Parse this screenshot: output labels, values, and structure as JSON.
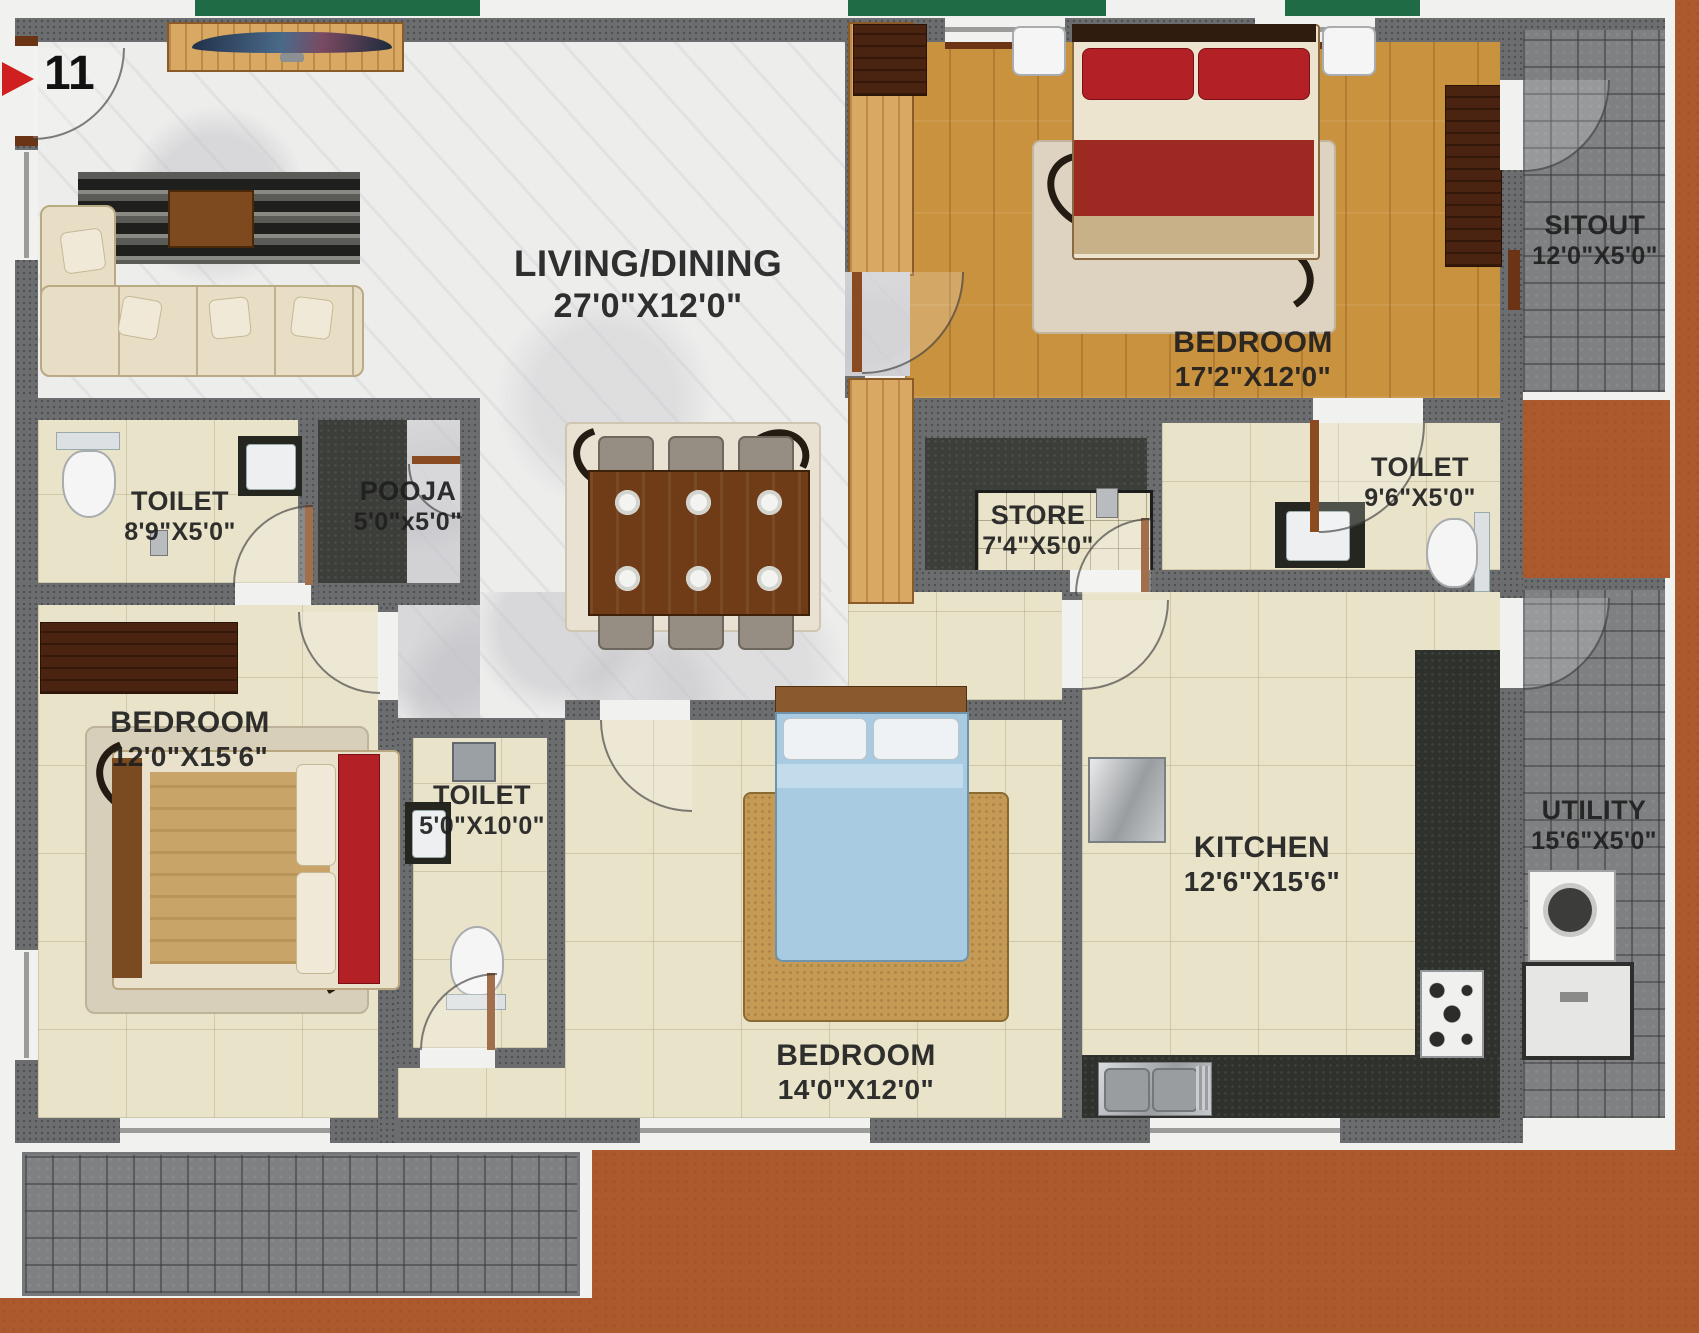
{
  "unit": {
    "number": "11"
  },
  "rooms": {
    "living_dining": {
      "name": "LIVING/DINING",
      "size": "27'0\"X12'0\""
    },
    "bedroom_top": {
      "name": "BEDROOM",
      "size": "17'2\"X12'0\""
    },
    "sitout": {
      "name": "SITOUT",
      "size": "12'0\"X5'0\""
    },
    "toilet_left": {
      "name": "TOILET",
      "size": "8'9\"X5'0\""
    },
    "pooja": {
      "name": "POOJA",
      "size": "5'0\"x5'0\""
    },
    "store": {
      "name": "STORE",
      "size": "7'4\"X5'0\""
    },
    "toilet_right": {
      "name": "TOILET",
      "size": "9'6\"X5'0\""
    },
    "bedroom_left": {
      "name": "BEDROOM",
      "size": "12'0\"X15'6\""
    },
    "toilet_middle": {
      "name": "TOILET",
      "size": "5'0\"X10'0\""
    },
    "bedroom_middle": {
      "name": "BEDROOM",
      "size": "14'0\"X12'0\""
    },
    "kitchen": {
      "name": "KITCHEN",
      "size": "12'6\"X15'6\""
    },
    "utility": {
      "name": "UTILITY",
      "size": "15'6\"X5'0\""
    }
  },
  "colors": {
    "terracotta": "#ac5a2d",
    "wall": "#6b6d6f",
    "marble": "#ededec",
    "beige": "#e9e3ca",
    "wood": "#c9923f",
    "cobble": "#7e8082",
    "dark_floor": "#3c3e3a",
    "green": "#1f6b46",
    "door_brown": "#8a4b20",
    "bed_red": "#b32025",
    "bed_blue": "#a9cbe2",
    "sofa_cream": "#e8dec6",
    "label": "#1f1f1f"
  }
}
